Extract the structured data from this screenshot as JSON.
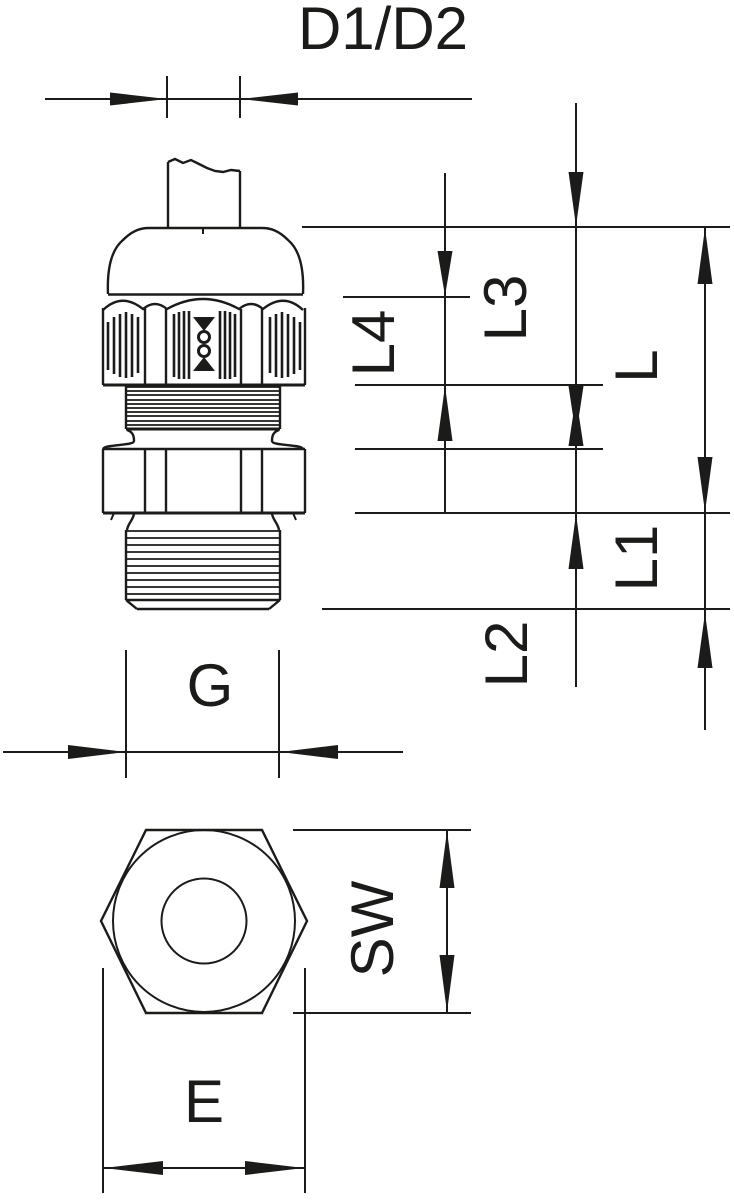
{
  "drawing": {
    "dimension_labels": {
      "cable_diameter": "D1/D2",
      "l4": "L4",
      "l3": "L3",
      "total_length": "L",
      "l1": "L1",
      "l2": "L2",
      "thread": "G",
      "wrench_size": "SW",
      "across_corners": "E"
    }
  }
}
